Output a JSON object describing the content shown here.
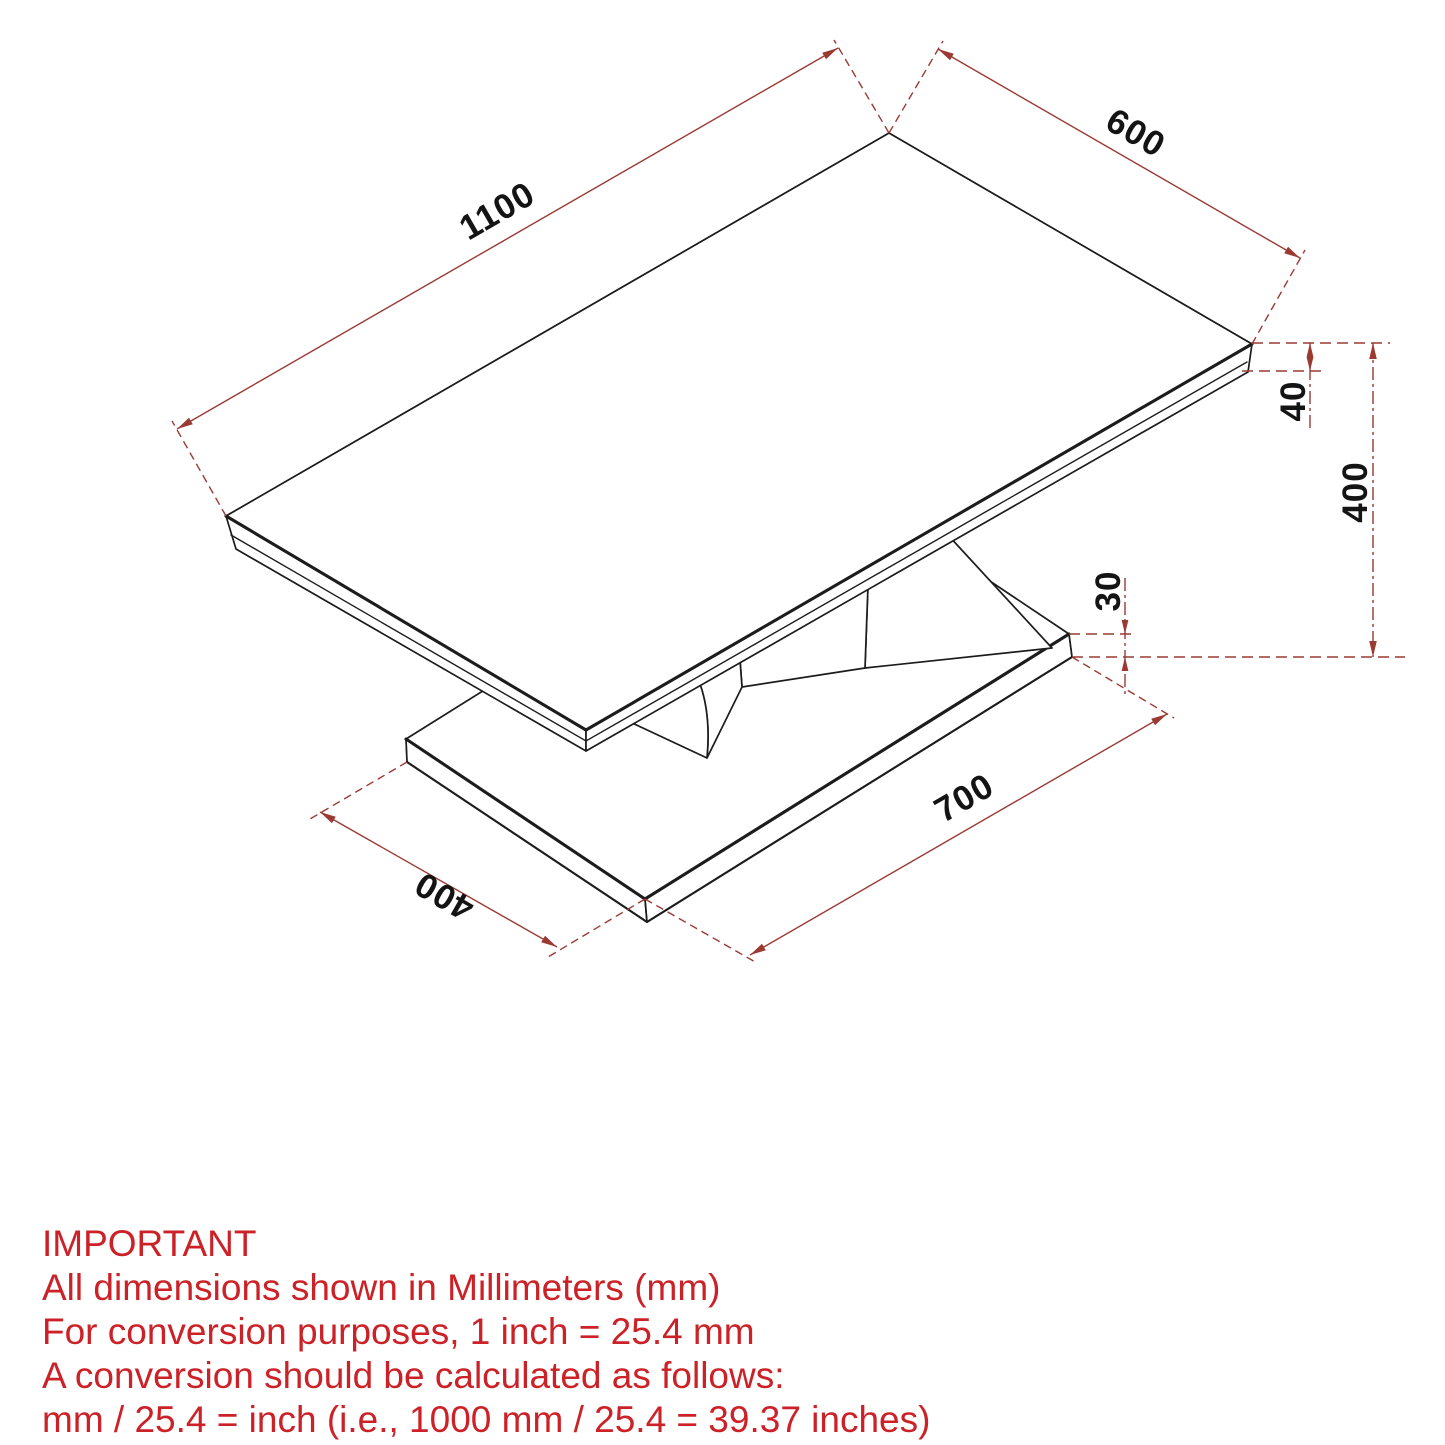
{
  "drawing": {
    "type": "isometric-technical-drawing",
    "subject": "coffee table with slab top, folded V pedestal and plinth base",
    "units": "mm",
    "dimensions": [
      {
        "part": "tabletop",
        "measure": "length",
        "label": "1100"
      },
      {
        "part": "tabletop",
        "measure": "width",
        "label": "600"
      },
      {
        "part": "tabletop",
        "measure": "thickness",
        "label": "40"
      },
      {
        "part": "overall",
        "measure": "height",
        "label": "400"
      },
      {
        "part": "base",
        "measure": "thickness",
        "label": "30"
      },
      {
        "part": "base",
        "measure": "length",
        "label": "700"
      },
      {
        "part": "base",
        "measure": "width",
        "label": "400"
      }
    ]
  },
  "notes": {
    "title": "IMPORTANT",
    "lines": [
      "All dimensions shown in Millimeters (mm)",
      "For conversion purposes, 1 inch = 25.4 mm",
      "A conversion should be calculated as follows:",
      "mm / 25.4 = inch (i.e., 1000 mm / 25.4 = 39.37 inches)"
    ]
  },
  "colors": {
    "background": "#ffffff",
    "drawing_line": "#1c1c1c",
    "dimension_line_red": "#9a3a33",
    "dimension_number": "#141414",
    "note_red": "#cc2127"
  }
}
